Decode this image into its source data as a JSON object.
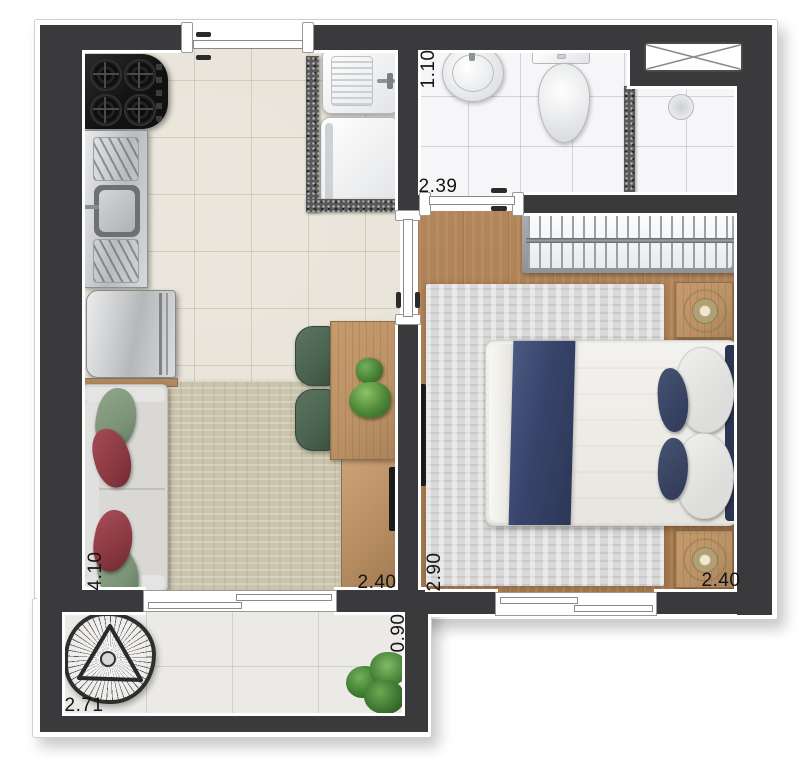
{
  "labels": {
    "bath_width": "1.10",
    "bath_length": "2.39",
    "living_length": "4.10",
    "living_width": "2.40",
    "bedroom_length": "2.90",
    "bedroom_width": "2.40",
    "balcony_depth": "0.90",
    "balcony_width": "2.71"
  },
  "colors": {
    "wall": "#3a3a3c",
    "trim": "#ffffff",
    "tileLiving": "#e8e3d8",
    "tileBath": "#f6f6f8",
    "tileBalcony": "#eceae7",
    "wood": "#ac8054",
    "furnWood": "#bb9267",
    "rugLiving": "#cbc4ac",
    "rugBedroom": "#d9d9d9",
    "sofa": "#d9d8d5",
    "cushGreen": "#7c9377",
    "cushRed": "#8c3a43",
    "chairGreen": "#4b6351",
    "navy": "#37436a",
    "navyDark": "#2c3552",
    "granite": "#59595a"
  }
}
